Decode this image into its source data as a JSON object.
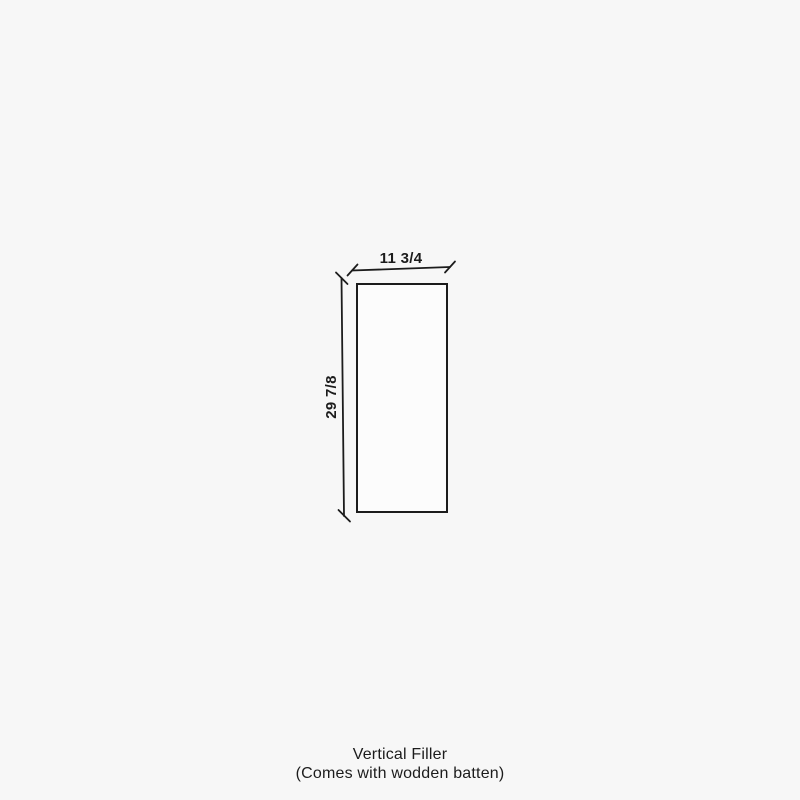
{
  "page": {
    "background_color": "#f7f7f7"
  },
  "colors": {
    "line": "#1c1c1c",
    "text": "#1c1c1c",
    "rect_fill": "#fcfcfc"
  },
  "diagram": {
    "type": "dimension-drawing",
    "shape": "vertical rectangle",
    "width_label": "11 3/4",
    "height_label": "29 7/8"
  },
  "caption": {
    "line1": "Vertical Filler",
    "line2": "(Comes with wodden batten)"
  }
}
